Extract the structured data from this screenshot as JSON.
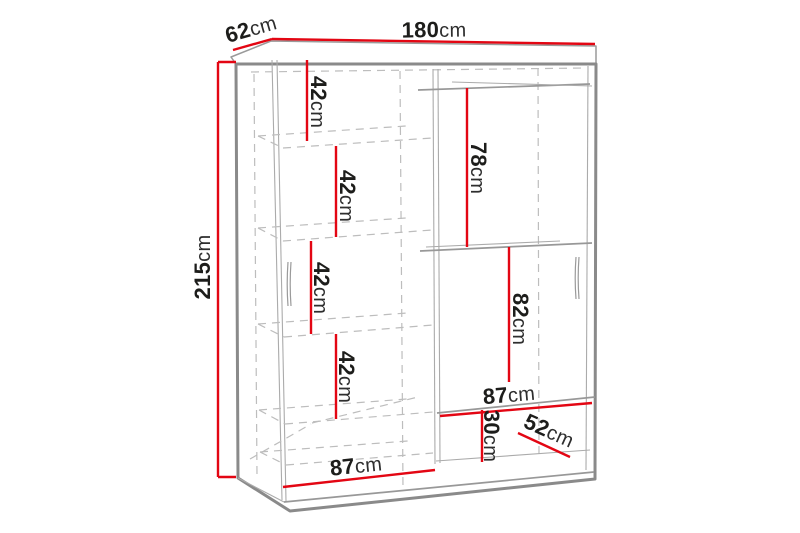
{
  "diagram": {
    "subject": "wardrobe-dimension-drawing",
    "unit": "cm",
    "colors": {
      "dimension_line": "#e30613",
      "drawing_line": "#8a8a8a",
      "hidden_line": "#bdbdbd",
      "text": "#1d1d1b",
      "background": "#ffffff"
    },
    "overall": {
      "width": "180cm",
      "depth": "62cm",
      "height": "215cm"
    },
    "interior": {
      "left_shelf_spacings": [
        "42cm",
        "42cm",
        "42cm",
        "42cm"
      ],
      "hanging_section_height": "78cm",
      "right_lower_section_height": "82cm",
      "right_section_width": "87cm",
      "bottom_section_height": "30cm",
      "usable_depth": "52cm",
      "left_section_width": "87cm"
    },
    "labels": [
      {
        "id": "width-top",
        "num": "180",
        "unit": "cm"
      },
      {
        "id": "depth-top",
        "num": "62",
        "unit": "cm"
      },
      {
        "id": "height-left",
        "num": "215",
        "unit": "cm"
      },
      {
        "id": "shelf-gap-1",
        "num": "42",
        "unit": "cm"
      },
      {
        "id": "shelf-gap-2",
        "num": "42",
        "unit": "cm"
      },
      {
        "id": "shelf-gap-3",
        "num": "42",
        "unit": "cm"
      },
      {
        "id": "shelf-gap-4",
        "num": "42",
        "unit": "cm"
      },
      {
        "id": "hanging-height",
        "num": "78",
        "unit": "cm"
      },
      {
        "id": "right-lower-height",
        "num": "82",
        "unit": "cm"
      },
      {
        "id": "right-width",
        "num": "87",
        "unit": "cm"
      },
      {
        "id": "bottom-height",
        "num": "30",
        "unit": "cm"
      },
      {
        "id": "inner-depth",
        "num": "52",
        "unit": "cm"
      },
      {
        "id": "left-width",
        "num": "87",
        "unit": "cm"
      }
    ]
  }
}
